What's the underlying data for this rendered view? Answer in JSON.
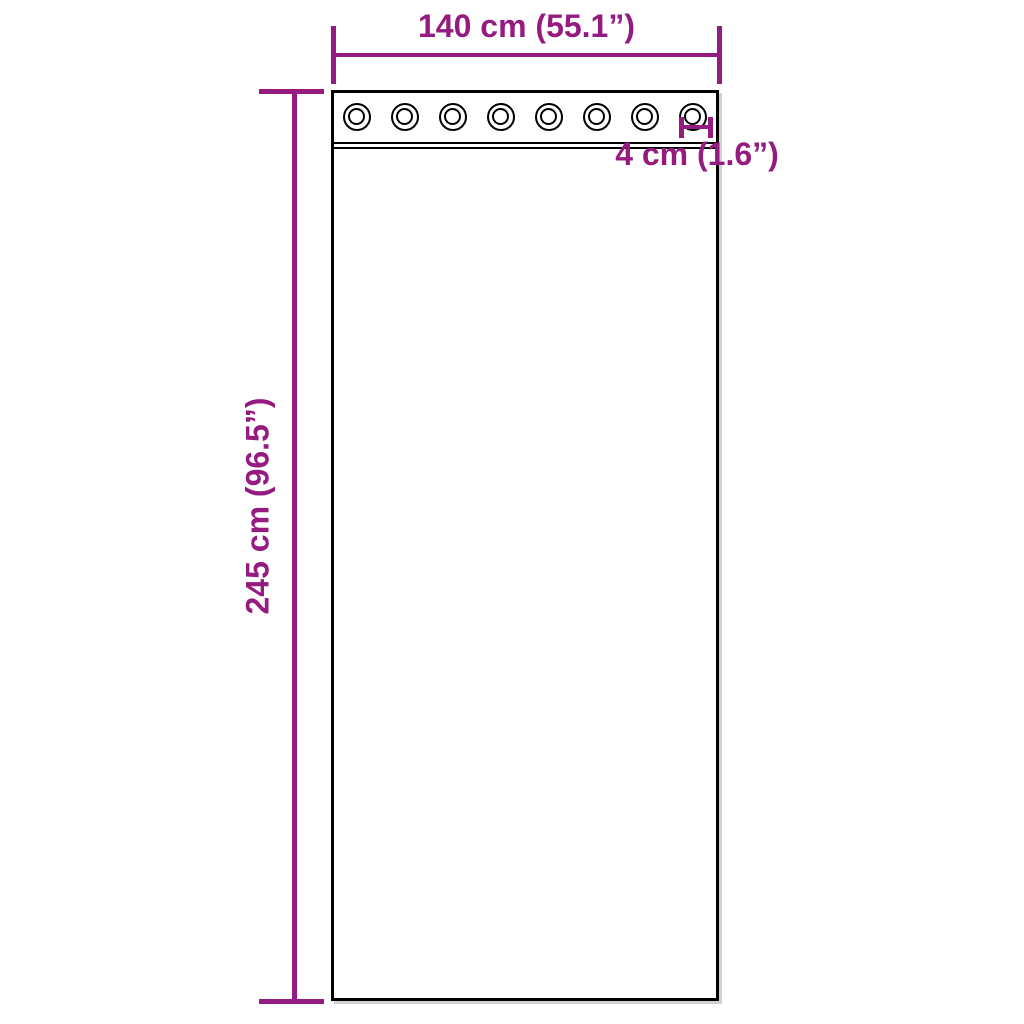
{
  "diagram": {
    "background_color": "#ffffff",
    "outline_color": "#000000",
    "dimension_color": "#951B81",
    "width_dim": {
      "label": "140 cm (55.1”)"
    },
    "height_dim": {
      "label": "245 cm (96.5”)"
    },
    "grommet_dim": {
      "label": "4 cm (1.6”)"
    },
    "grommets": {
      "count": 8
    }
  }
}
